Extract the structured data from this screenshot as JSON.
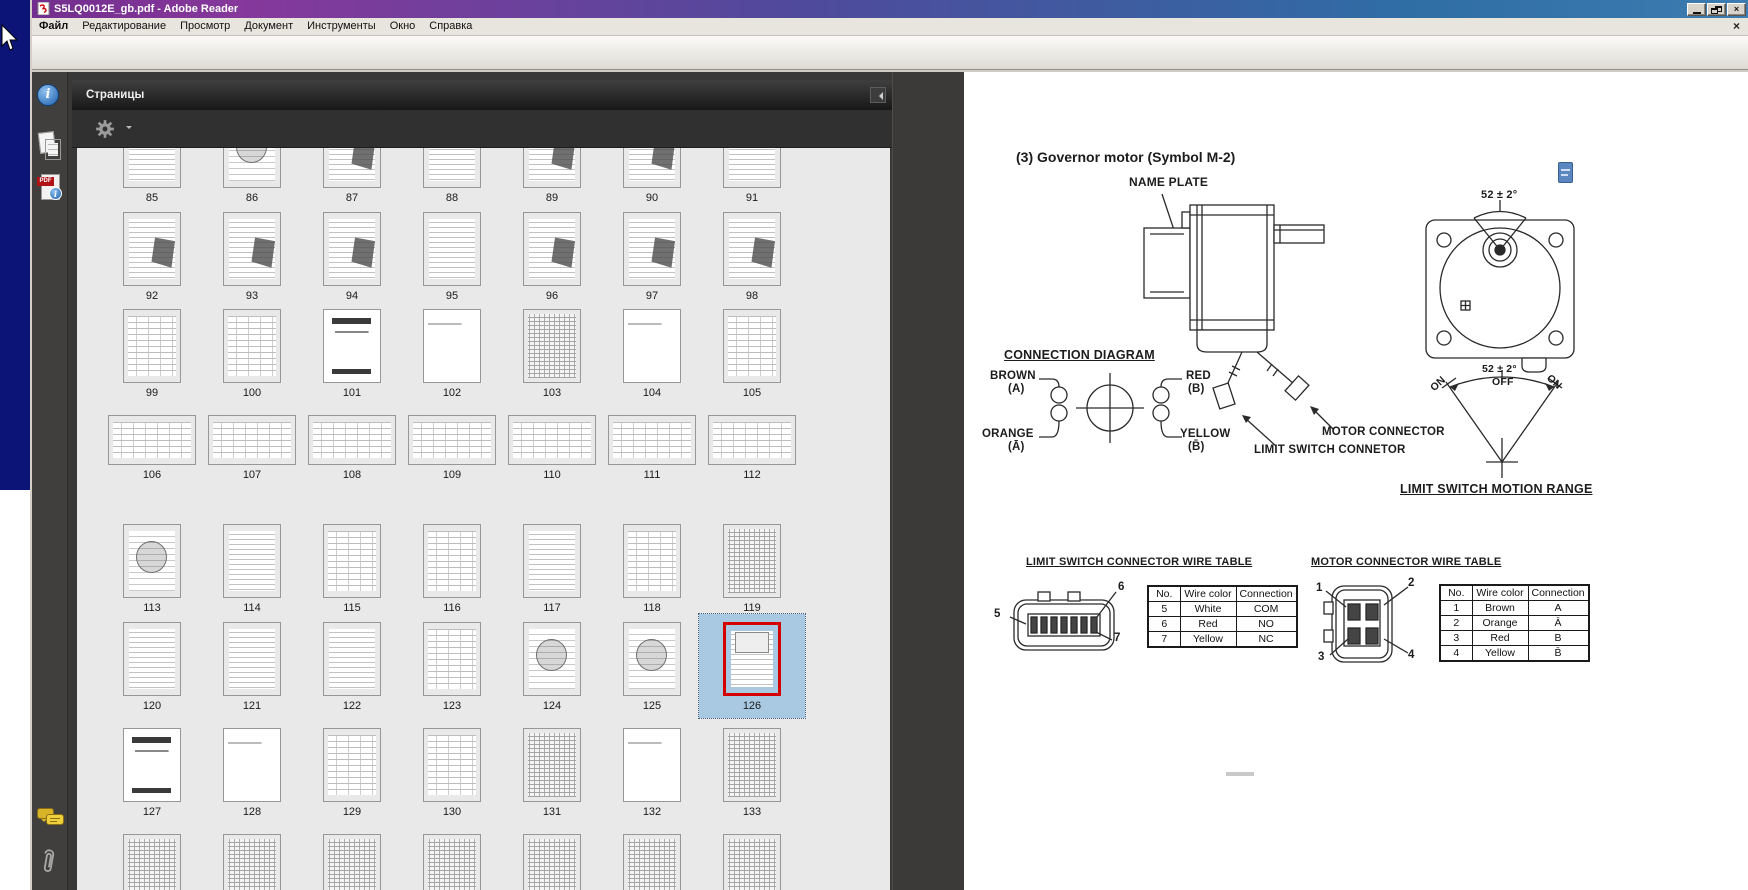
{
  "desktop": {
    "top_color": "#0c1478",
    "bottom_color": "#ffffff"
  },
  "window": {
    "title": "S5LQ0012E_gb.pdf - Adobe Reader",
    "controls": {
      "minimize": "_",
      "restore": "❐",
      "close": "×"
    },
    "menu_close": "×"
  },
  "menu": {
    "items": [
      "Файл",
      "Редактирование",
      "Просмотр",
      "Документ",
      "Инструменты",
      "Окно",
      "Справка"
    ]
  },
  "toolbar": {
    "page_value": "126",
    "page_total": "/ 1030",
    "zoom_value": "75%",
    "find_placeholder": "Найти",
    "icons": [
      "print-icon",
      "email-export-icon",
      "collaborate-icon",
      "previous-page-icon",
      "next-page-icon",
      "zoom-out-icon",
      "zoom-in-icon",
      "fit-width-icon",
      "fit-page-icon"
    ]
  },
  "nav": {
    "panel_title": "Страницы",
    "side_icons": [
      "info-icon",
      "pages-icon",
      "pdf-info-icon",
      "comments-icon",
      "attachments-icon"
    ],
    "accent_selection_color": "#a9c8e1",
    "selected_border_color": "#d40000"
  },
  "thumbnails": {
    "selected_page": 126,
    "rows": [
      {
        "orientation": "portrait",
        "pages": [
          {
            "n": 85,
            "k": "lines"
          },
          {
            "n": 86,
            "k": "diagram"
          },
          {
            "n": 87,
            "k": "mixed"
          },
          {
            "n": 88,
            "k": "lines"
          },
          {
            "n": 89,
            "k": "mixed"
          },
          {
            "n": 90,
            "k": "mixed"
          },
          {
            "n": 91,
            "k": "lines"
          }
        ]
      },
      {
        "orientation": "portrait",
        "pages": [
          {
            "n": 92,
            "k": "mixed"
          },
          {
            "n": 93,
            "k": "mixed"
          },
          {
            "n": 94,
            "k": "mixed"
          },
          {
            "n": 95,
            "k": "lines"
          },
          {
            "n": 96,
            "k": "mixed"
          },
          {
            "n": 97,
            "k": "mixed"
          },
          {
            "n": 98,
            "k": "mixed"
          }
        ]
      },
      {
        "orientation": "portrait",
        "pages": [
          {
            "n": 99,
            "k": "table"
          },
          {
            "n": 100,
            "k": "table"
          },
          {
            "n": 101,
            "k": "title"
          },
          {
            "n": 102,
            "k": "light"
          },
          {
            "n": 103,
            "k": "dense"
          },
          {
            "n": 104,
            "k": "light"
          },
          {
            "n": 105,
            "k": "table"
          }
        ]
      },
      {
        "orientation": "landscape",
        "pages": [
          {
            "n": 106,
            "k": "table"
          },
          {
            "n": 107,
            "k": "table"
          },
          {
            "n": 108,
            "k": "table"
          },
          {
            "n": 109,
            "k": "table"
          },
          {
            "n": 110,
            "k": "table"
          },
          {
            "n": 111,
            "k": "table"
          },
          {
            "n": 112,
            "k": "table"
          }
        ]
      },
      {
        "orientation": "portrait",
        "pages": [
          {
            "n": 113,
            "k": "diagram"
          },
          {
            "n": 114,
            "k": "lines"
          },
          {
            "n": 115,
            "k": "table"
          },
          {
            "n": 116,
            "k": "table"
          },
          {
            "n": 117,
            "k": "lines"
          },
          {
            "n": 118,
            "k": "table"
          },
          {
            "n": 119,
            "k": "dense"
          }
        ]
      },
      {
        "orientation": "portrait",
        "pages": [
          {
            "n": 120,
            "k": "lines"
          },
          {
            "n": 121,
            "k": "lines"
          },
          {
            "n": 122,
            "k": "lines"
          },
          {
            "n": 123,
            "k": "table"
          },
          {
            "n": 124,
            "k": "diagram"
          },
          {
            "n": 125,
            "k": "diagram"
          },
          {
            "n": 126,
            "k": "motor"
          }
        ]
      },
      {
        "orientation": "portrait",
        "pages": [
          {
            "n": 127,
            "k": "title"
          },
          {
            "n": 128,
            "k": "light"
          },
          {
            "n": 129,
            "k": "table"
          },
          {
            "n": 130,
            "k": "table"
          },
          {
            "n": 131,
            "k": "dense"
          },
          {
            "n": 132,
            "k": "light"
          },
          {
            "n": 133,
            "k": "dense"
          }
        ]
      },
      {
        "orientation": "portrait",
        "pages": [
          {
            "n": 134,
            "k": "dense"
          },
          {
            "n": 135,
            "k": "dense"
          },
          {
            "n": 136,
            "k": "dense"
          },
          {
            "n": 137,
            "k": "dense"
          },
          {
            "n": 138,
            "k": "dense"
          },
          {
            "n": 139,
            "k": "dense"
          },
          {
            "n": 140,
            "k": "dense"
          }
        ]
      }
    ]
  },
  "doc": {
    "labels": {
      "heading": "(3) Governor motor (Symbol M-2)",
      "name_plate": "NAME PLATE",
      "angle_top": "52 ± 2°",
      "connection_diagram": "CONNECTION DIAGRAM",
      "brown": "BROWN",
      "brown_sub": "(A)",
      "orange": "ORANGE",
      "orange_sub": "(Ā)",
      "red": "RED",
      "red_sub": "(B)",
      "yellow": "YELLOW",
      "yellow_sub": "(B̄)",
      "motor_connector": "MOTOR CONNECTOR",
      "limit_switch_connetor": "LIMIT SWITCH CONNETOR",
      "motion_angle": "52 ± 2°",
      "motion_off": "OFF",
      "motion_on_left": "ON",
      "motion_on_right": "ON",
      "motion_range": "LIMIT SWITCH MOTION RANGE"
    },
    "limit_table": {
      "title": "LIMIT SWITCH CONNECTOR WIRE TABLE",
      "headers": [
        "No.",
        "Wire color",
        "Connection"
      ],
      "rows": [
        [
          "5",
          "White",
          "COM"
        ],
        [
          "6",
          "Red",
          "NO"
        ],
        [
          "7",
          "Yellow",
          "NC"
        ]
      ],
      "pins": [
        "5",
        "6",
        "7"
      ]
    },
    "motor_table": {
      "title": "MOTOR CONNECTOR WIRE TABLE",
      "headers": [
        "No.",
        "Wire color",
        "Connection"
      ],
      "rows": [
        [
          "1",
          "Brown",
          "A"
        ],
        [
          "2",
          "Orange",
          "Ā"
        ],
        [
          "3",
          "Red",
          "B"
        ],
        [
          "4",
          "Yellow",
          "B̄"
        ]
      ],
      "pins": [
        "1",
        "2",
        "3",
        "4"
      ]
    }
  }
}
